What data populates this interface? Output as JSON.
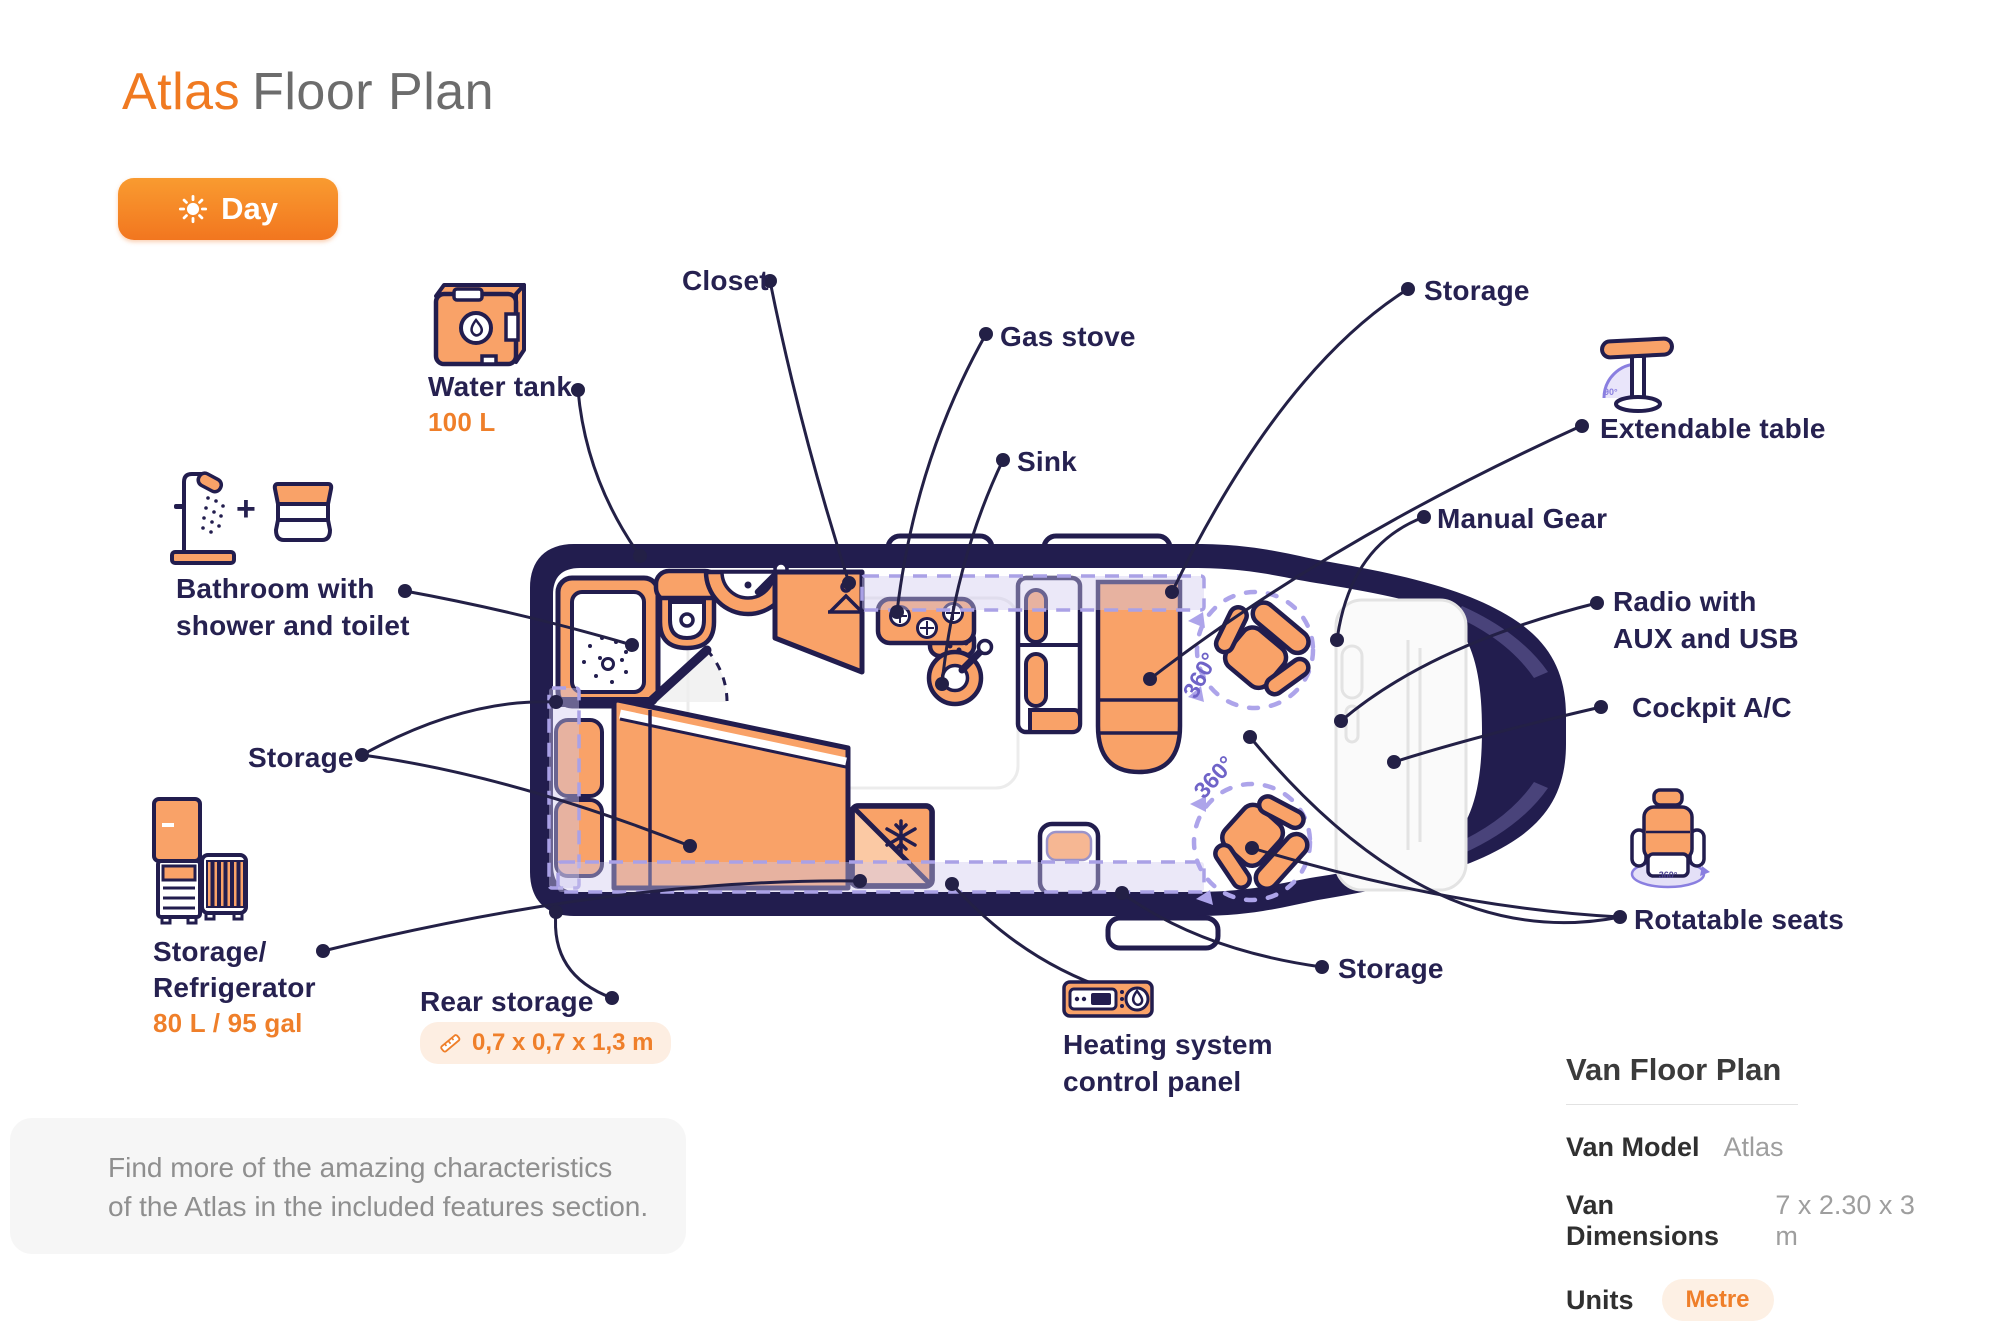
{
  "title": {
    "brand": "Atlas",
    "rest": "Floor Plan"
  },
  "mode_toggle": {
    "label": "Day",
    "icon": "sun-icon"
  },
  "plan": {
    "seat_rotation": "360°",
    "table_angle": "90°"
  },
  "labels": {
    "water_tank": {
      "name": "Water tank",
      "capacity": "100 L"
    },
    "closet": "Closet",
    "gas_stove": "Gas stove",
    "sink": "Sink",
    "storage_top": "Storage",
    "extendable_table": "Extendable table",
    "manual_gear": "Manual Gear",
    "radio": {
      "line1": "Radio with",
      "line2": "AUX and USB"
    },
    "cockpit_ac": "Cockpit A/C",
    "rotatable_seats": "Rotatable seats",
    "storage_cab": "Storage",
    "heating": {
      "line1": "Heating system",
      "line2": "control panel"
    },
    "rear_storage": {
      "name": "Rear storage",
      "dimensions": "0,7 x 0,7 x 1,3 m"
    },
    "storage_left": "Storage",
    "refrigerator": {
      "line1": "Storage/",
      "line2": "Refrigerator",
      "capacity": "80 L / 95 gal"
    },
    "bathroom": {
      "line1": "Bathroom with",
      "line2": "shower and toilet"
    }
  },
  "note": {
    "line1": "Find more of the amazing characteristics",
    "line2": "of the Atlas in the included features section."
  },
  "info_panel": {
    "title": "Van Floor Plan",
    "rows": [
      {
        "label": "Van Model",
        "value": "Atlas"
      },
      {
        "label": "Van Dimensions",
        "value": "7 x 2.30 x 3 m"
      },
      {
        "label": "Units",
        "value": "Metre"
      }
    ]
  },
  "colors": {
    "accent_orange": "#f4811f",
    "furniture_orange": "#f9a268",
    "outline_navy": "#221d4e",
    "storage_purple": "#a9a0e8",
    "text_navy": "#262150",
    "accent_text": "#ef7f2a"
  }
}
